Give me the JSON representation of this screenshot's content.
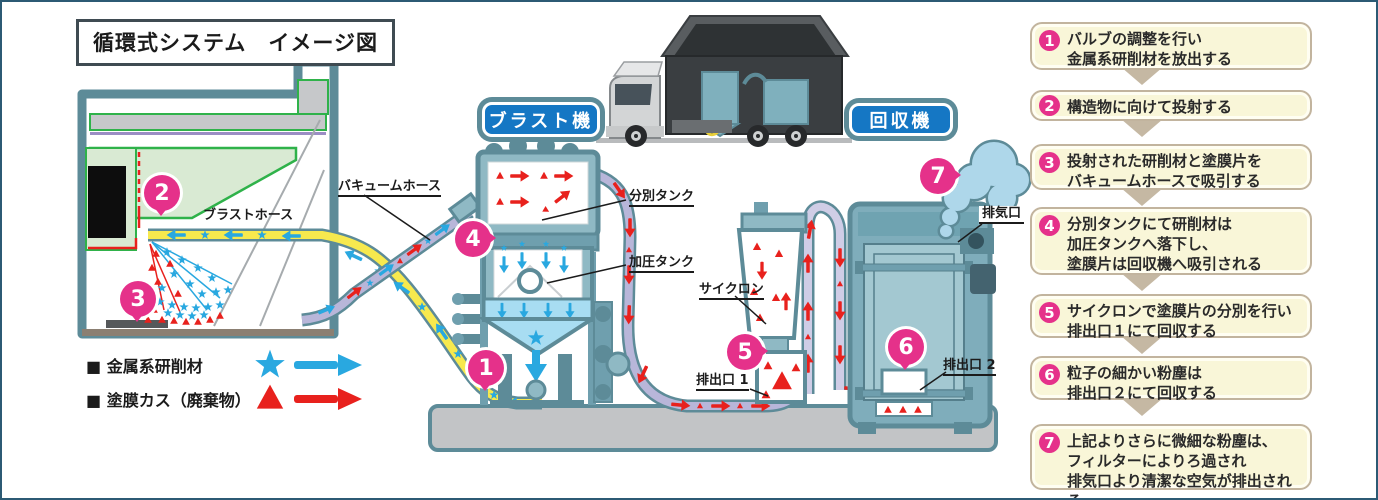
{
  "title": "循環式システム　イメージ図",
  "machine_labels": {
    "blast": "ブラスト機",
    "recovery": "回収機"
  },
  "part_labels": {
    "vacuum_hose": "バキュームホース",
    "blast_hose": "ブラストホース",
    "separation_tank": "分別タンク",
    "pressure_tank": "加圧タンク",
    "cyclone": "サイクロン",
    "outlet1": "排出口 1",
    "outlet2": "排出口 2",
    "exhaust_port": "排気口"
  },
  "badges": [
    "1",
    "2",
    "3",
    "4",
    "5",
    "6",
    "7"
  ],
  "legend": {
    "items": [
      {
        "label": "■ 金属系研削材",
        "marker": "star-icon",
        "color": "#29a8e0"
      },
      {
        "label": "■ 塗膜カス（廃棄物）",
        "marker": "triangle-icon",
        "color": "#e8211d"
      }
    ]
  },
  "steps": [
    {
      "num": "1",
      "lines": [
        "バルブの調整を行い",
        "金属系研削材を放出する"
      ]
    },
    {
      "num": "2",
      "lines": [
        "構造物に向けて投射する"
      ]
    },
    {
      "num": "3",
      "lines": [
        "投射された研削材と塗膜片を",
        "バキュームホースで吸引する"
      ]
    },
    {
      "num": "4",
      "lines": [
        "分別タンクにて研削材は",
        "加圧タンクへ落下し、",
        "塗膜片は回収機へ吸引される"
      ]
    },
    {
      "num": "5",
      "lines": [
        "サイクロンで塗膜片の分別を行い",
        "排出口１にて回収する"
      ]
    },
    {
      "num": "6",
      "lines": [
        "粒子の細かい粉塵は",
        "排出口２にて回収する"
      ]
    },
    {
      "num": "7",
      "lines": [
        "上記よりさらに微細な粉塵は、",
        "フィルターによりろ過され",
        "排気口より清潔な空気が排出される"
      ]
    }
  ],
  "colors": {
    "abrasive_blue": "#29a8e0",
    "waste_red": "#e8211d",
    "badge_magenta": "#e5318a",
    "machine_teal": "#5d8b98",
    "label_blue": "#1577c4",
    "hose_yellow": "#f7e94e",
    "hose_lavender": "#b8b6d9",
    "step_box_bg": "#f9f6d8",
    "step_box_border": "#c2b49e"
  }
}
